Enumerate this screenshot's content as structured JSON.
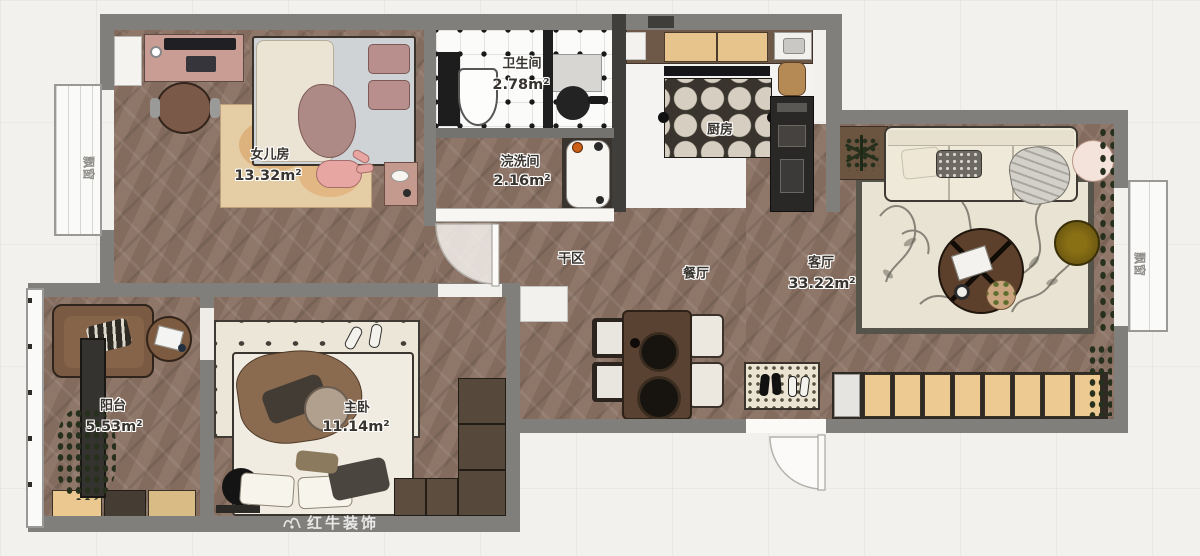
{
  "rooms": {
    "daughter": {
      "name": "女儿房",
      "area": "13.32m²"
    },
    "bathroom": {
      "name": "卫生间",
      "area": "2.78m²"
    },
    "laundry": {
      "name": "浣洗间",
      "area": "2.16m²"
    },
    "kitchen": {
      "name": "厨房",
      "area": ""
    },
    "dry_area": {
      "name": "干区",
      "area": ""
    },
    "dining": {
      "name": "餐厅",
      "area": ""
    },
    "living": {
      "name": "客厅",
      "area": "33.22m²"
    },
    "balcony": {
      "name": "阳台",
      "area": "5.53m²"
    },
    "master": {
      "name": "主卧",
      "area": "11.14m²"
    }
  },
  "windows": {
    "left_bay": "飘窗",
    "right_bay": "飘窗"
  },
  "watermark": {
    "brand": "红牛装饰"
  },
  "colors": {
    "wall": "#807f7c",
    "wood_floor": "#8a7163",
    "accent_wood_cabinet": "#ecca92",
    "rug_cream": "#e8e3d2"
  }
}
